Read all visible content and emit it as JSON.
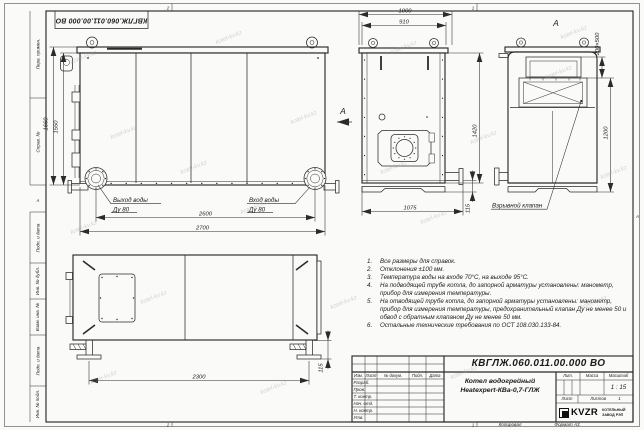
{
  "watermark": {
    "text": "kotel-kv.kz"
  },
  "sheet": {
    "fold_top_left": "2",
    "fold_top_right": "1",
    "fold_bottom_left": "2",
    "fold_bottom_right": "1",
    "zone_right": "А",
    "zone_left": "А"
  },
  "stamp": {
    "doc_number": "КВГЛЖ.060.011.00.000 ВО"
  },
  "margin": {
    "cells": [
      "Перв. примен.",
      "Справ. №",
      "Подп. и дата",
      "Инв. № дубл.",
      "Взам. инв. №",
      "Подп. и дата",
      "Инв. № подл."
    ]
  },
  "front_view": {
    "dim_height_overall": "1660",
    "dim_height_body": "1550",
    "dim_width_flanges": "2600",
    "dim_width_overall": "2700",
    "outlet_label": "Выход воды",
    "outlet_dn": "Ду 80",
    "inlet_label": "Вход воды",
    "inlet_dn": "Ду 80",
    "arrow_label": "А"
  },
  "end_view": {
    "dim_width_overall": "1000",
    "dim_width_casing": "910",
    "dim_height": "1420",
    "dim_foot": "115",
    "dim_width_bottom": "1075"
  },
  "view_a": {
    "title": "А",
    "dim_valve": "200×500",
    "dim_height": "1200",
    "valve_label": "Взрывной клапан"
  },
  "top_view": {
    "dim_legs": "2300",
    "dim_foot": "115"
  },
  "notes": {
    "items": [
      {
        "n": "1.",
        "text": "Все размеры для справок."
      },
      {
        "n": "2.",
        "text": "Отклонения ±100 мм."
      },
      {
        "n": "3.",
        "text": "Температура воды на входе 70°С, на выходе 95°С."
      },
      {
        "n": "4.",
        "text": "На подводящей трубе котла, до запорной арматуры установлены: манометр, прибор для измерения температуры."
      },
      {
        "n": "5.",
        "text": "На отводящей трубе котла, до запорной арматуры установлены: манометр, прибор для измерения температуры, предохранительный клапан Ду не менее 50 и обвод с обратным клапаном Ду не менее 50 мм."
      },
      {
        "n": "6.",
        "text": "Остальные технические требования по ОСТ 108.030.133-84."
      }
    ]
  },
  "title_block": {
    "doc_number": "КВГЛЖ.060.011.00.000 ВО",
    "product_line1": "Котел водогрейный",
    "product_line2": "Heatexpert-КВа-0,7-ГЛЖ",
    "col_izm": "Изм.",
    "col_list": "Лист",
    "col_docnum": "№ докум.",
    "col_podp": "Подп.",
    "col_data": "Дата",
    "row_razrab": "Разраб.",
    "row_prov": "Пров.",
    "row_tkontr": "Т. контр.",
    "row_nachotd": "Нач. отд.",
    "row_nkontr": "Н. контр.",
    "row_utv": "Утв.",
    "lit_label": "Лит.",
    "mass_label": "Масса",
    "scale_label": "Масштаб",
    "scale_value": "1 : 15",
    "sheet_label": "Лист",
    "sheets_label": "Листов",
    "sheets_value": "1",
    "logo_text": "KVZR",
    "logo_sub1": "КОТЕЛЬНЫЙ",
    "logo_sub2": "ЗАВОД РЭП",
    "footer_copy": "Копировал",
    "footer_format": "Формат А3"
  }
}
